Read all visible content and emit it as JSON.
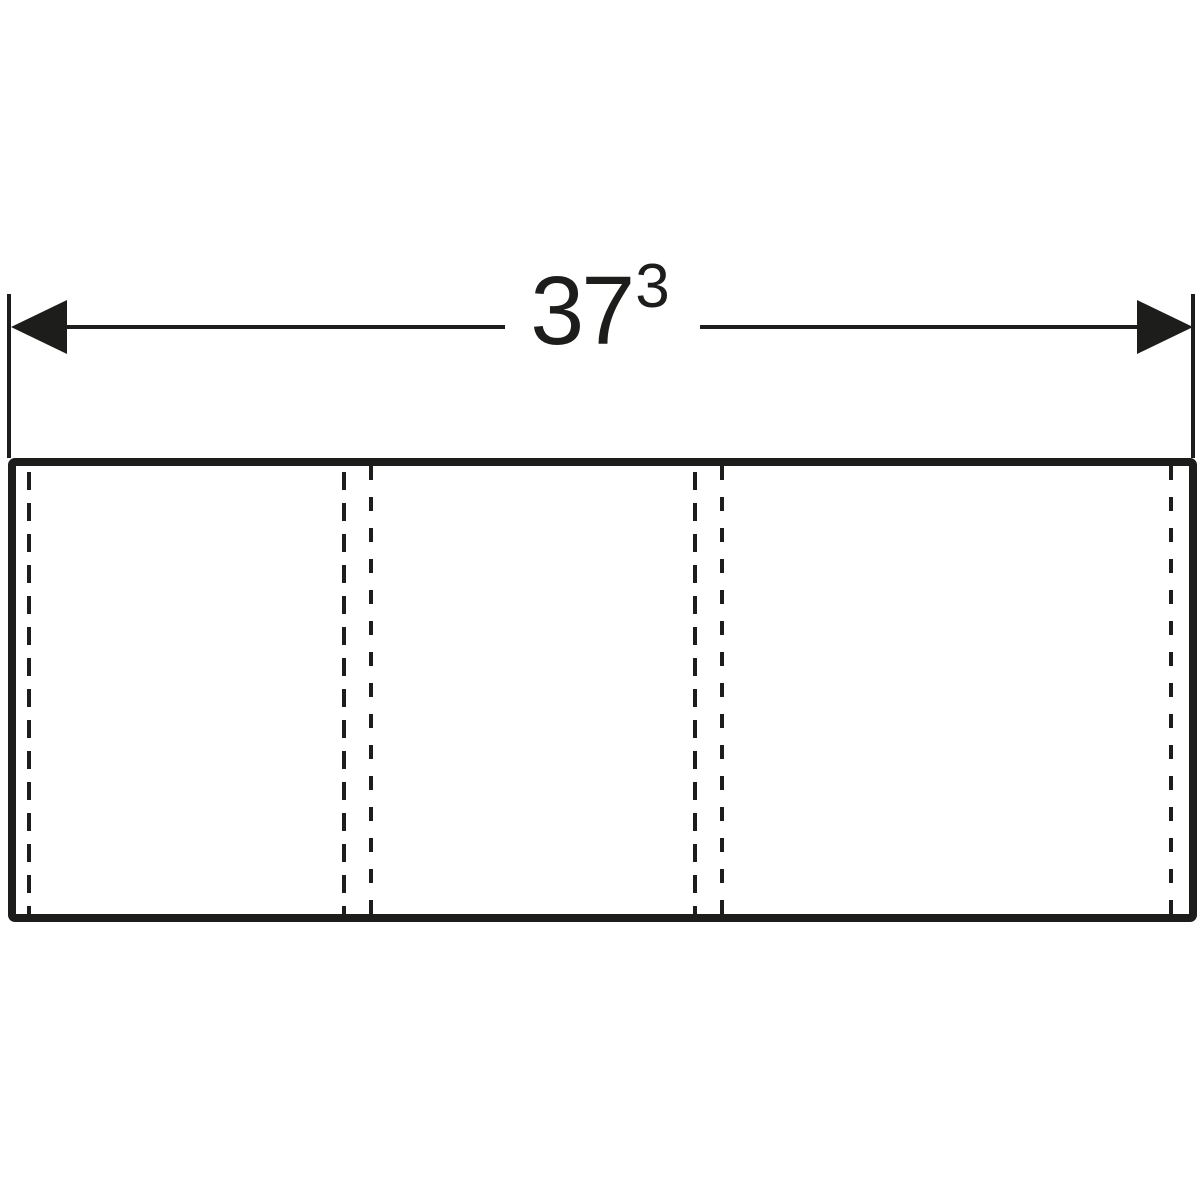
{
  "page": {
    "background": "#ffffff",
    "ink_color": "#1d1d1b",
    "description": "Technical dimension drawing of a three-section cabinet front panel"
  },
  "dimension": {
    "value": "37",
    "superscript": "3"
  },
  "icons": {
    "left_arrowhead": "filled-triangle-pointing-left",
    "right_arrowhead": "filled-triangle-pointing-right"
  }
}
